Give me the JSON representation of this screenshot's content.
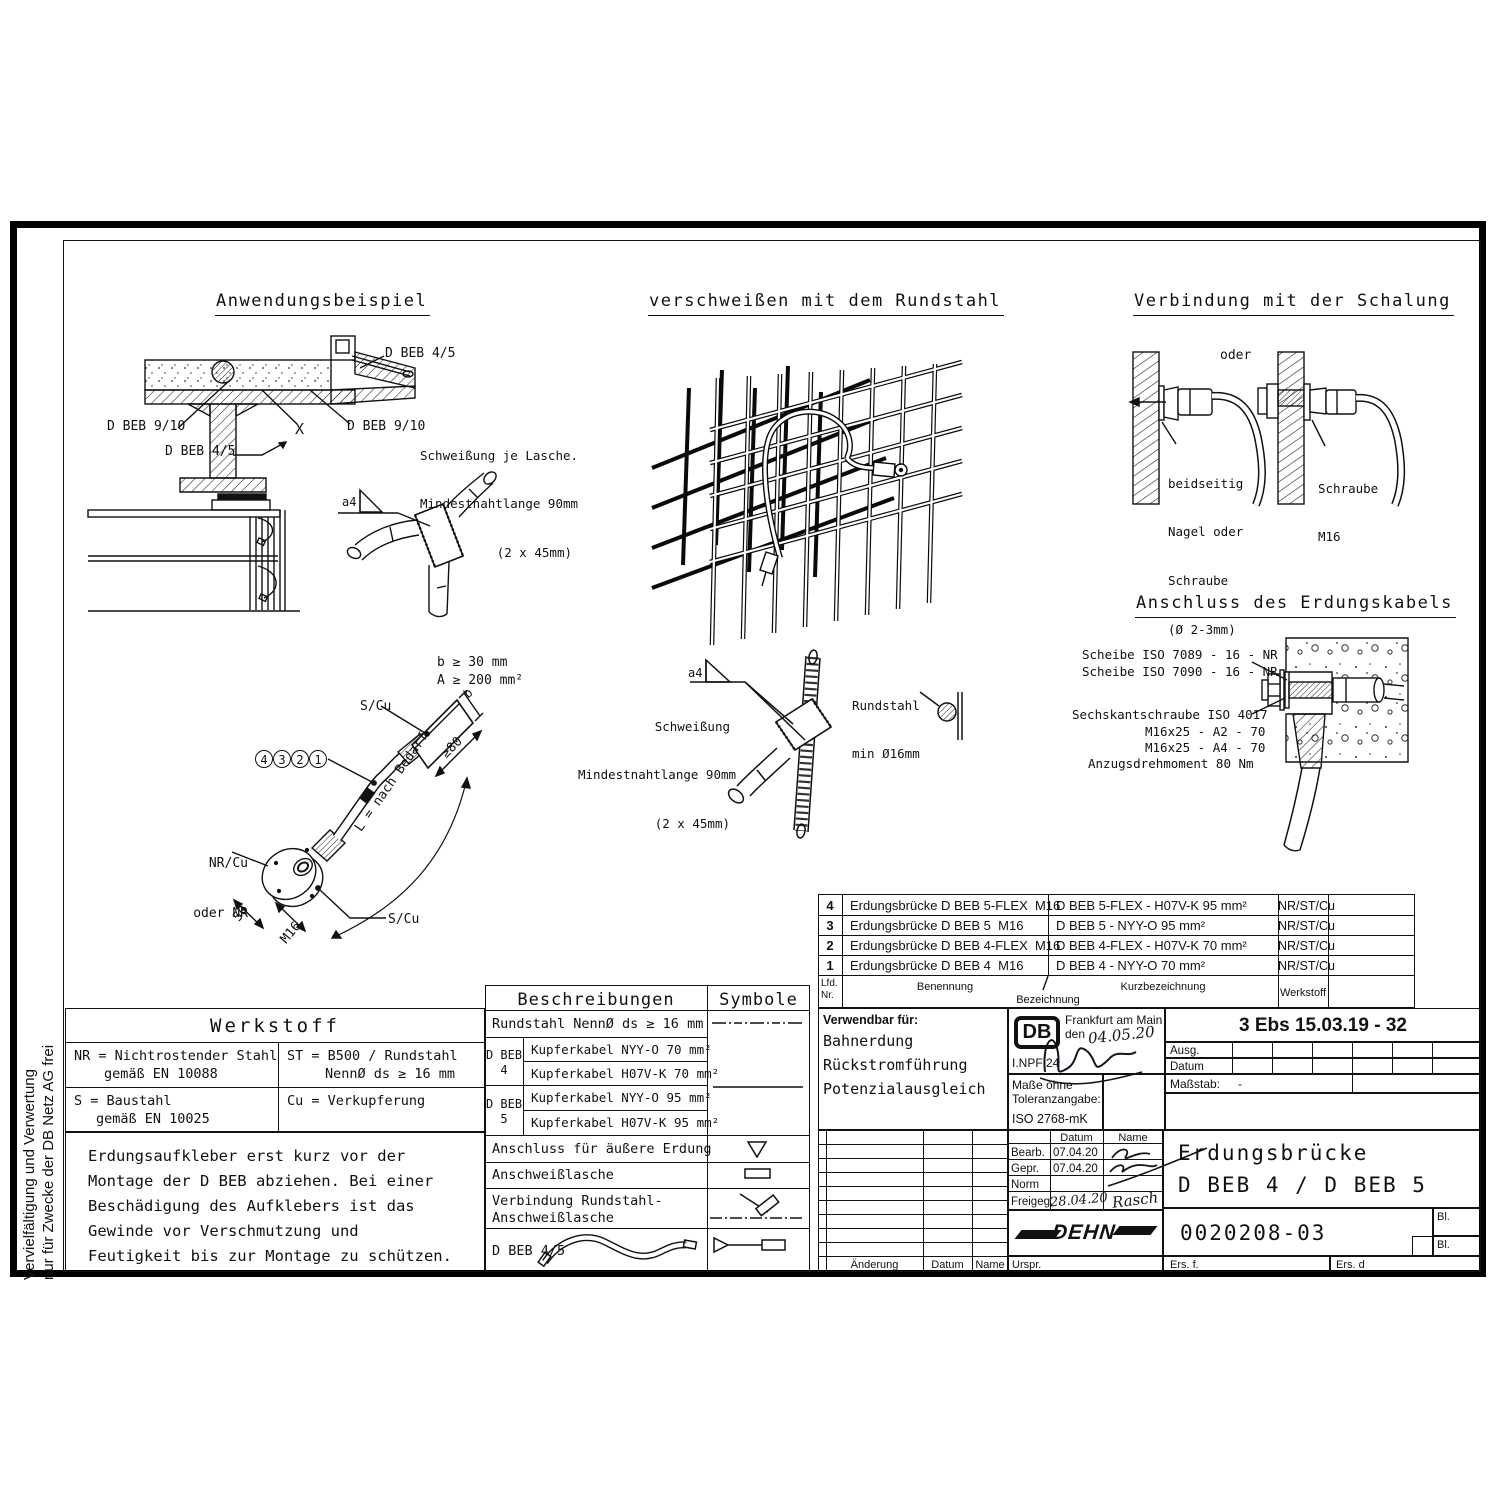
{
  "page": {
    "margin_l1": "Vervielfältigung und Verwertung",
    "margin_l2": "nur für Zwecke der DB Netz AG frei"
  },
  "fig_anwendung": {
    "title": "Anwendungsbeispiel",
    "dbeb45_top": "D BEB 4/5",
    "dbeb910_left": "D BEB 9/10",
    "x_mark": "X",
    "dbeb910_right": "D BEB 9/10",
    "weld_l1": "Schweißung je Lasche.",
    "weld_l2": "Mindestnahtlange 90mm",
    "weld_l3": "(2 x 45mm)",
    "dbeb45_lower": "D BEB 4/5",
    "a4": "a4"
  },
  "fig_mesh": {
    "title": "verschweißen mit dem Rundstahl"
  },
  "fig_schalung": {
    "title": "Verbindung mit der Schalung",
    "oder": "oder",
    "left_l1": "beidseitig",
    "left_l2": "Nagel oder",
    "left_l3": "Schraube",
    "left_l4": "(Ø 2-3mm)",
    "right_l1": "Schraube",
    "right_l2": "M16"
  },
  "fig_kabel": {
    "dim_b": "b ≥ 30 mm",
    "dim_a": "A ≥ 200 mm²",
    "scu_top": "S/Cu",
    "b_letter": "b",
    "geq80": "≥80",
    "callouts": [
      "4",
      "3",
      "2",
      "1"
    ],
    "nrcu_l1": "NR/Cu",
    "nrcu_l2": "oder NR",
    "dim50": "50",
    "m16": "M16",
    "scu_bottom": "S/Cu",
    "laenge": "L = nach Bedarf"
  },
  "fig_weld": {
    "a4": "a4",
    "l1": "Schweißung",
    "l2": "Mindestnahtlange 90mm",
    "l3": "(2 x 45mm)",
    "rund_l1": "Rundstahl",
    "rund_l2": "min Ø16mm"
  },
  "fig_anschluss": {
    "title": "Anschluss des Erdungskabels",
    "scheibe1": "Scheibe ISO 7089 - 16 - NR",
    "scheibe2": "Scheibe ISO 7090 - 16 - NR",
    "schraube": "Sechskantschraube ISO 4017",
    "m1": "M16x25 - A2 - 70",
    "m2": "M16x25 - A4 - 70",
    "moment": "Anzugsdrehmoment 80 Nm"
  },
  "parts": {
    "header": {
      "lfd": "Lfd.",
      "nr": "Nr.",
      "benennung": "Benennung",
      "bezeichnung": "Bezeichnung",
      "kurz": "Kurzbezeichnung",
      "werkstoff": "Werkstoff"
    },
    "rows": [
      {
        "nr": "4",
        "ben": "Erdungsbrücke D BEB 5-FLEX  M16",
        "kurz": "D BEB 5-FLEX - H07V-K 95 mm²",
        "ws": "NR/ST/Cu"
      },
      {
        "nr": "3",
        "ben": "Erdungsbrücke D BEB 5  M16",
        "kurz": "D BEB 5 - NYY-O 95 mm²",
        "ws": "NR/ST/Cu"
      },
      {
        "nr": "2",
        "ben": "Erdungsbrücke D BEB 4-FLEX  M16",
        "kurz": "D BEB 4-FLEX - H07V-K 70 mm²",
        "ws": "NR/ST/Cu"
      },
      {
        "nr": "1",
        "ben": "Erdungsbrücke D BEB 4  M16",
        "kurz": "D BEB 4 - NYY-O 70 mm²",
        "ws": "NR/ST/Cu"
      }
    ]
  },
  "werkstoff": {
    "title": "Werkstoff",
    "nr_l1": "NR = Nichtrostender Stahl",
    "nr_l2": "gemäß EN 10088",
    "st_l1": "ST = B500 / Rundstahl",
    "st_l2": "NennØ ds ≥ 16 mm",
    "s_l1": "S = Baustahl",
    "s_l2": "gemäß EN 10025",
    "cu": "Cu = Verkupferung",
    "note": "Erdungsaufkleber erst kurz vor der\nMontage der D BEB abziehen. Bei einer\nBeschädigung des Aufklebers ist das\nGewinde vor Verschmutzung und\nFeutigkeit bis zur Montage zu schützen."
  },
  "beschreibungen": {
    "title": "Beschreibungen",
    "symbole": "Symbole",
    "r1": "Rundstahl NennØ ds ≥ 16 mm",
    "g1": "D BEB",
    "g1nr": "4",
    "g2": "D BEB",
    "g2nr": "5",
    "k1": "Kupferkabel NYY-O 70 mm²",
    "k2": "Kupferkabel H07V-K 70 mm²",
    "k3": "Kupferkabel NYY-O 95 mm²",
    "k4": "Kupferkabel H07V-K 95 mm²",
    "r3": "Anschluss für äußere Erdung",
    "r4": "Anschweißlasche",
    "r5_l1": "Verbindung Rundstahl-",
    "r5_l2": "Anschweißlasche",
    "r6": "D BEB 4/5"
  },
  "tb": {
    "verwendbar": "Verwendbar für:",
    "v1": "Bahnerdung",
    "v2": "Rückstromführung",
    "v3": "Potenzialausgleich",
    "db": "DB",
    "ort": "Frankfurt am Main",
    "den": "den",
    "hand_date": "04.05.20",
    "inpf": "I.NPF 24",
    "masse_l1": "Maße ohne",
    "masse_l2": "Toleranzangabe:",
    "masse_l3": "ISO 2768-mK",
    "ebs": "3 Ebs 15.03.19 - 32",
    "ausg": "Ausg.",
    "datum_row": "Datum",
    "massstab": "Maßstab:",
    "massstab_val": "-",
    "col_datum": "Datum",
    "col_name": "Name",
    "bearb": "Bearb.",
    "bearb_dat": "07.04.20",
    "gepr": "Gepr.",
    "gepr_dat": "07.04.20",
    "norm": "Norm",
    "freigeg": "Freigeg.",
    "frei_dat": "28.04.20",
    "frei_name": "Rasch",
    "dehn": "DEHN",
    "title_l1": "Erdungsbrücke",
    "title_l2": "D BEB 4 / D BEB 5",
    "dnr": "0020208-03",
    "bl1": "Bl.",
    "bl2": "Bl.",
    "aenderung": "Änderung",
    "datum2": "Datum",
    "name2": "Name",
    "urspr": "Urspr.",
    "ersf": "Ers. f.",
    "ersd": "Ers. d"
  }
}
